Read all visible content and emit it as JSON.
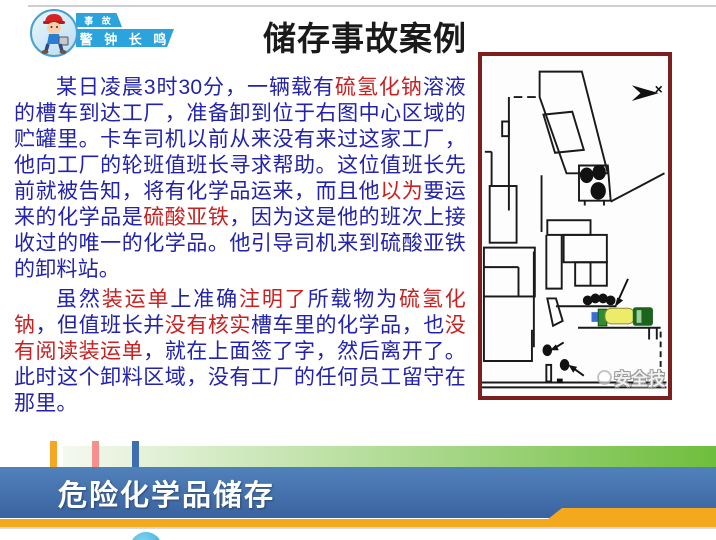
{
  "badge": {
    "tag": "事 故",
    "slogan": "警 钟 长 鸣"
  },
  "title": "储存事故案例",
  "case_text": {
    "paragraph1": [
      {
        "text": "某日凌晨3时30分，一辆载有",
        "color": "blue"
      },
      {
        "text": "硫氢化钠",
        "color": "red"
      },
      {
        "text": "溶液的槽车到达工厂，准备卸到位于右图中心区域的贮罐里。卡车司机以前从来没有来过这家工厂，他向工厂的轮班值班长寻求帮助。这位值班长先前就被告知，将有化学品运来，而且他",
        "color": "blue"
      },
      {
        "text": "以为",
        "color": "red"
      },
      {
        "text": "要运来的化学品是",
        "color": "blue"
      },
      {
        "text": "硫酸亚铁",
        "color": "red"
      },
      {
        "text": "，因为这是他的班次上接收过的唯一的化学品。他引导司机来到硫酸亚铁的卸料站。",
        "color": "blue"
      }
    ],
    "paragraph2": [
      {
        "text": "虽然",
        "color": "blue"
      },
      {
        "text": "装运单",
        "color": "red"
      },
      {
        "text": "上准确",
        "color": "blue"
      },
      {
        "text": "注明了",
        "color": "red"
      },
      {
        "text": "所载物为",
        "color": "blue"
      },
      {
        "text": "硫氢化钠",
        "color": "red"
      },
      {
        "text": "，但值班长并",
        "color": "blue"
      },
      {
        "text": "没有核实",
        "color": "red"
      },
      {
        "text": "槽车里的化学品，也",
        "color": "blue"
      },
      {
        "text": "没有阅读装运单",
        "color": "red"
      },
      {
        "text": "，就在上面签了字，然后离开了。此时这个卸料区域，没有工厂的任何员工留守在那里。",
        "color": "blue"
      }
    ]
  },
  "map": {
    "watermark": "安全技"
  },
  "footer": {
    "banner_label": "危险化学品储存"
  },
  "icons": {
    "north_arrow_icon": "dart-right-arrow",
    "worker_cartoon_icon": "cartoon-worker-red-helmet",
    "watermark_logo_icon": "circle-face-logo",
    "storage_tanks": "black-filled-circles",
    "tanker_truck": "yellow-tank-truck"
  },
  "colors": {
    "body_blue": "#2222ad",
    "highlight_red": "#c92020",
    "title_black": "#1a1a1a",
    "map_border": "#7b1f1f",
    "ribbon_blue": "#2ba3dc",
    "banner_blue_top": "#5181bb",
    "banner_blue_bottom": "#3a639f",
    "banner_orange": "#f3a81d",
    "green_strip_start": "#f4f9ef",
    "green_strip_end": "#6fbe3d",
    "tick_orange": "#f5a623",
    "tick_pink": "#f78f8f",
    "tick_blue": "#3e6db0",
    "truck_yellow": "#ecec6a",
    "truck_cab": "#1c641c",
    "truck_green": "#2f8f2f",
    "truck_blue": "#3a6fd8",
    "bottom_circle": "#2e9fd4"
  }
}
